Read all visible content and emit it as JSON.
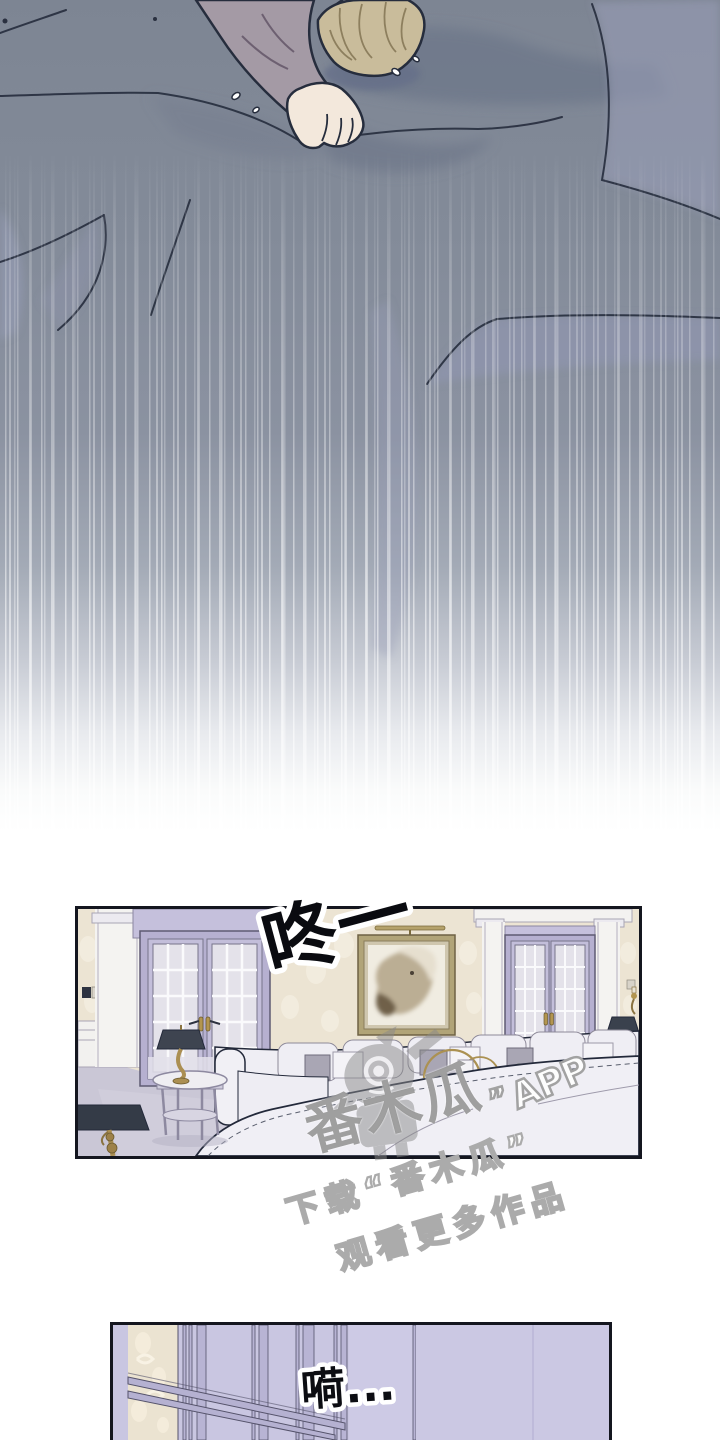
{
  "page": {
    "kind": "webtoon comic page",
    "background": "#ffffff",
    "width": 720,
    "height": 1440
  },
  "panels": {
    "bed_scene": {
      "label": "bed-scene-bleed-panel"
    },
    "living_room": {
      "label": "living-room-panel"
    },
    "window_closeup": {
      "label": "window-closeup-panel"
    }
  },
  "sound_effects": {
    "thud": "咚一",
    "sigh": "嗬..."
  },
  "watermark": {
    "brand": "番木瓜",
    "close_quote": "”",
    "app_label": "APP",
    "tagline_line1": "下载“番木瓜”",
    "tagline_line2": "观看更多作品"
  },
  "colors": {
    "bed_base": "#828a99",
    "bed_shadow": "#6e7789",
    "bed_fold_lavender": "#989db6",
    "outline": "#262d3d",
    "skin": "#f3e8dc",
    "hair": "#c9bc9b",
    "sleeve": "#a49aa5",
    "panel_border": "#14161f",
    "wallpaper": "#ece4d3",
    "door_frame_lavender": "#b6b0d0",
    "window_pane": "#e4e2ea",
    "floor": "#cac7d6",
    "sofa_white": "#efeef4",
    "lamp_shade_dark": "#3a414d",
    "brass_gold": "#ab8f52",
    "bottom_panel_lavender": "#c9c6e1",
    "watermark_gray": "#9a9a9a"
  }
}
